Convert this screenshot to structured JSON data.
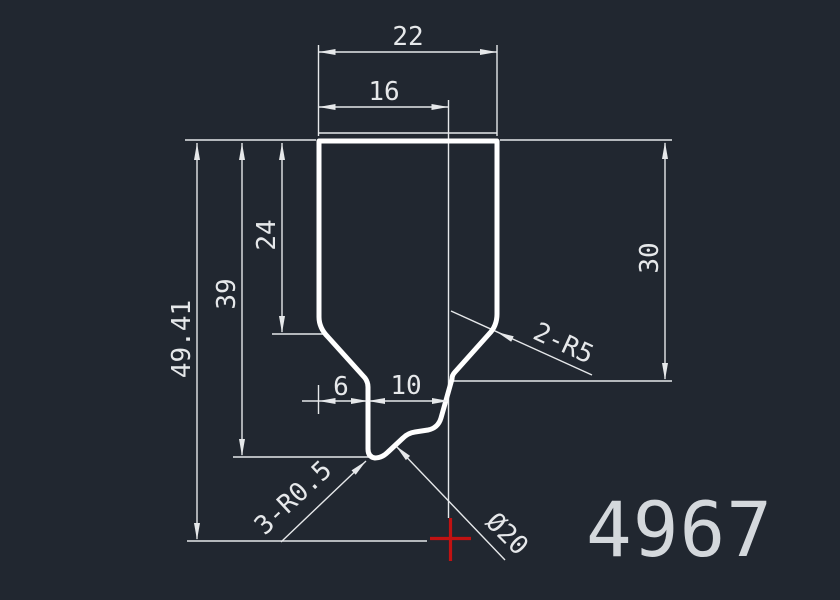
{
  "title": "CAD profile drawing",
  "drawing_number": "4967",
  "colors": {
    "background": "#212730",
    "profile_line": "#ffffff",
    "dimension_line": "#e6e8ea",
    "marker_red": "#c11212",
    "label_text": "#d4d8dc"
  },
  "dimensions": {
    "overall_width": "22",
    "inner_width": "16",
    "overall_height": "49.41",
    "height_to_tip": "39",
    "height_to_shoulder": "24",
    "right_side_height": "30",
    "neck_offset": "6",
    "neck_width": "10",
    "shoulder_fillets": "2-R5",
    "tip_fillets": "3-R0.5",
    "tip_diameter": "Ø20"
  }
}
